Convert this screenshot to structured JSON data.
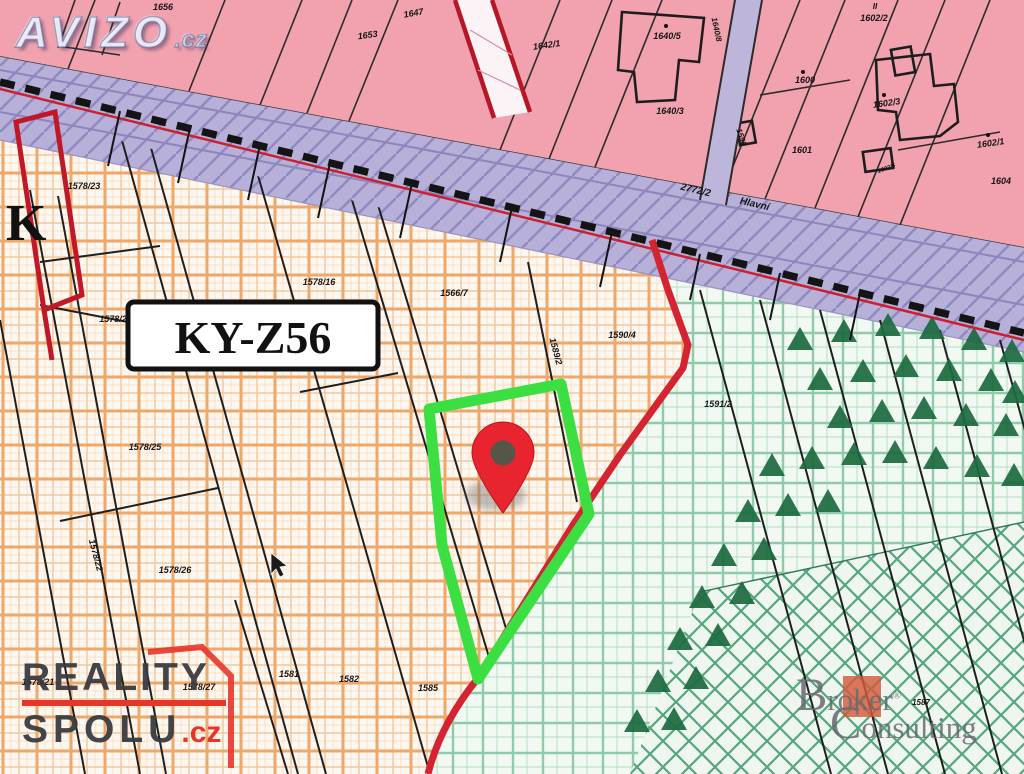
{
  "watermarks": {
    "avizo": {
      "text": "AVIZO",
      "suffix": ".cz"
    },
    "reality_spolu": {
      "line1": "REALITY",
      "line2": "SPOLU",
      "suffix": ".cz",
      "accent_color": "#e8352b",
      "text_color": "#3a3c40"
    },
    "broker": {
      "word1_initial": "B",
      "word1_rest": "roker",
      "word2_initial": "C",
      "word2_rest": "onsulting",
      "registered_mark": "®",
      "accent_color": "#d4593a"
    }
  },
  "map": {
    "zone_label": "KY-Z56",
    "sheet_letter": "K",
    "colors": {
      "pink_area": "#f2a2af",
      "road": "#b7b0d8",
      "orange_grid": "#efa869",
      "green_grid": "#8fcbaa",
      "forest_symbol": "#1d6b40",
      "boundary_red": "#d42432",
      "highlight_green": "#3bdf41",
      "pin_red": "#e8252e"
    },
    "parcel_labels": [
      {
        "t": "1656",
        "x": 163,
        "y": 10
      },
      {
        "t": "1653",
        "x": 368,
        "y": 38,
        "r": -8
      },
      {
        "t": "1647",
        "x": 414,
        "y": 16,
        "r": -10
      },
      {
        "t": "1642/1",
        "x": 547,
        "y": 48,
        "r": -8
      },
      {
        "t": "1640/5",
        "x": 667,
        "y": 39
      },
      {
        "t": "1640/8",
        "x": 714,
        "y": 30,
        "r": 78,
        "s": 8
      },
      {
        "t": "1640/3",
        "x": 670,
        "y": 114
      },
      {
        "t": "1599",
        "x": 739,
        "y": 138,
        "r": 72,
        "s": 8
      },
      {
        "t": "1600",
        "x": 805,
        "y": 83
      },
      {
        "t": "1601",
        "x": 802,
        "y": 153
      },
      {
        "t": "II",
        "x": 875,
        "y": 9,
        "s": 8
      },
      {
        "t": "1602/2",
        "x": 874,
        "y": 21
      },
      {
        "t": "1602/3",
        "x": 887,
        "y": 106,
        "r": -8
      },
      {
        "t": "1602/1",
        "x": 991,
        "y": 146,
        "r": -8
      },
      {
        "t": "1602/5",
        "x": 887,
        "y": 170,
        "s": 6,
        "r": -20
      },
      {
        "t": "1604",
        "x": 1001,
        "y": 184
      },
      {
        "t": "2772/2",
        "x": 695,
        "y": 193,
        "r": 13,
        "s": 10
      },
      {
        "t": "Hlavní",
        "x": 754,
        "y": 207,
        "r": 13,
        "s": 10
      },
      {
        "t": "1578/23",
        "x": 84,
        "y": 189
      },
      {
        "t": "1578/2",
        "x": 113,
        "y": 322
      },
      {
        "t": "1578/16",
        "x": 319,
        "y": 285
      },
      {
        "t": "1566/7",
        "x": 454,
        "y": 296
      },
      {
        "t": "1589/2",
        "x": 553,
        "y": 352,
        "r": 75
      },
      {
        "t": "1590/4",
        "x": 622,
        "y": 338
      },
      {
        "t": "1591/2",
        "x": 718,
        "y": 407
      },
      {
        "t": "1578/25",
        "x": 145,
        "y": 450
      },
      {
        "t": "1578/22",
        "x": 93,
        "y": 556,
        "r": 75
      },
      {
        "t": "1578/26",
        "x": 175,
        "y": 573
      },
      {
        "t": "1578/21",
        "x": 38,
        "y": 685
      },
      {
        "t": "1578/27",
        "x": 199,
        "y": 690
      },
      {
        "t": "1581",
        "x": 289,
        "y": 677
      },
      {
        "t": "1582",
        "x": 349,
        "y": 682
      },
      {
        "t": "1585",
        "x": 428,
        "y": 691
      },
      {
        "t": "1587",
        "x": 921,
        "y": 705,
        "s": 8
      }
    ]
  }
}
